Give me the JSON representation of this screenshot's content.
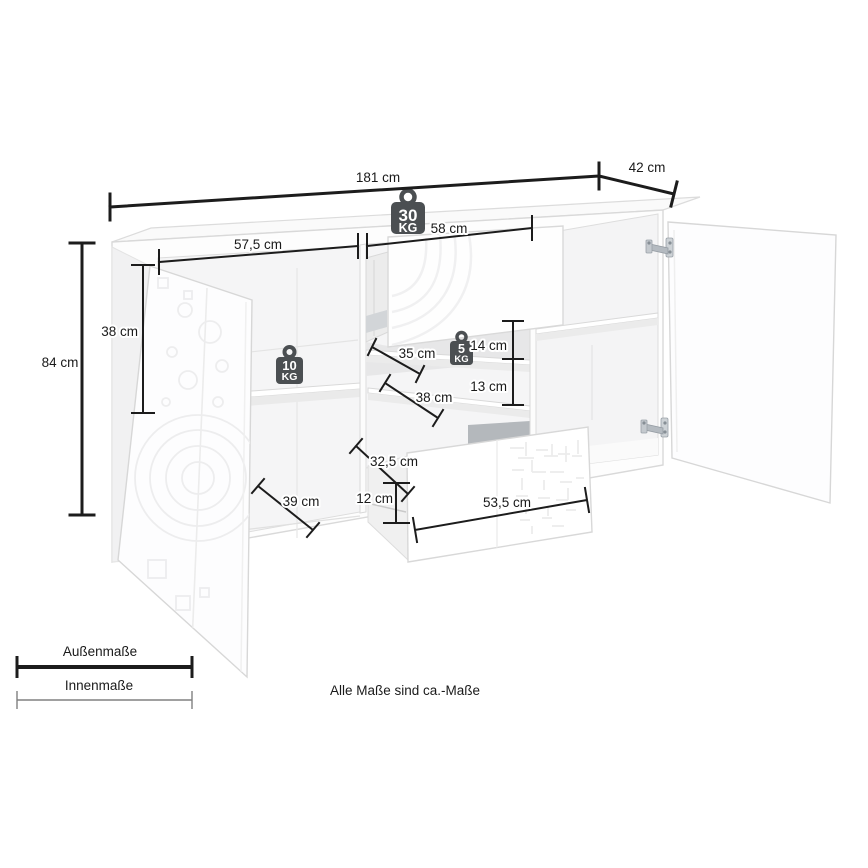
{
  "colors": {
    "dimension_line": "#1c1c1c",
    "inner_legend_line": "#808080",
    "load_badge": "#4b4f52",
    "furniture_edge": "#d9d9d9"
  },
  "dimensions": {
    "total_width": "181 cm",
    "depth": "42 cm",
    "total_height": "84 cm",
    "door_inner_height": "38 cm",
    "left_compartment_width": "57,5 cm",
    "middle_compartment_width": "58 cm",
    "upper_shelf_depth": "35 cm",
    "upper_compartment_height": "14 cm",
    "lower_compartment_height": "13 cm",
    "lower_shelf_depth": "38 cm",
    "drawer_inner_depth": "32,5 cm",
    "drawer_inner_height": "12 cm",
    "drawer_front_width": "53,5 cm",
    "bottom_compartment_depth": "39 cm"
  },
  "load_capacity": {
    "top_surface": {
      "value": "30",
      "unit": "KG"
    },
    "left_shelf": {
      "value": "10",
      "unit": "KG"
    },
    "middle_shelf": {
      "value": "5",
      "unit": "KG"
    }
  },
  "legend": {
    "outer_label": "Außenmaße",
    "inner_label": "Innenmaße"
  },
  "footnote": "Alle Maße sind ca.-Maße"
}
